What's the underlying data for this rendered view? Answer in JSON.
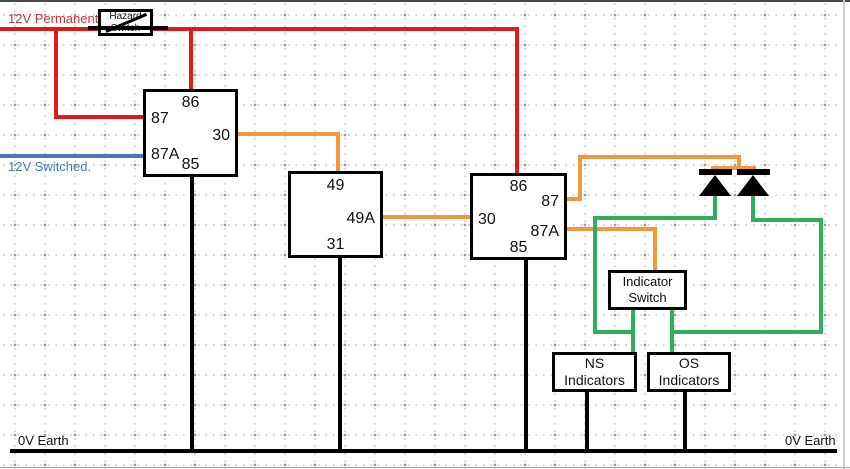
{
  "colors": {
    "supply_red": "#e01a1a",
    "switched_blue": "#4a7aad",
    "signal_orange": "#f0983a",
    "indicator_green": "#2fae5e",
    "earth_black": "#000000"
  },
  "labels": {
    "permanent": "12V Permanent",
    "switched": "12V Switched.",
    "earth_left": "0V Earth",
    "earth_right": "0V Earth"
  },
  "hazard_switch": {
    "line1": "Hazard",
    "line2": "Switch"
  },
  "relay1": {
    "pin_86": "86",
    "pin_87": "87",
    "pin_30": "30",
    "pin_87a": "87A",
    "pin_85": "85"
  },
  "flasher": {
    "pin_49": "49",
    "pin_49a": "49A",
    "pin_31": "31"
  },
  "relay2": {
    "pin_86": "86",
    "pin_87": "87",
    "pin_30": "30",
    "pin_87a": "87A",
    "pin_85": "85"
  },
  "indicator_switch": {
    "line1": "Indicator",
    "line2": "Switch"
  },
  "ns_indicators": {
    "line1": "NS",
    "line2": "Indicators"
  },
  "os_indicators": {
    "line1": "OS",
    "line2": "Indicators"
  }
}
